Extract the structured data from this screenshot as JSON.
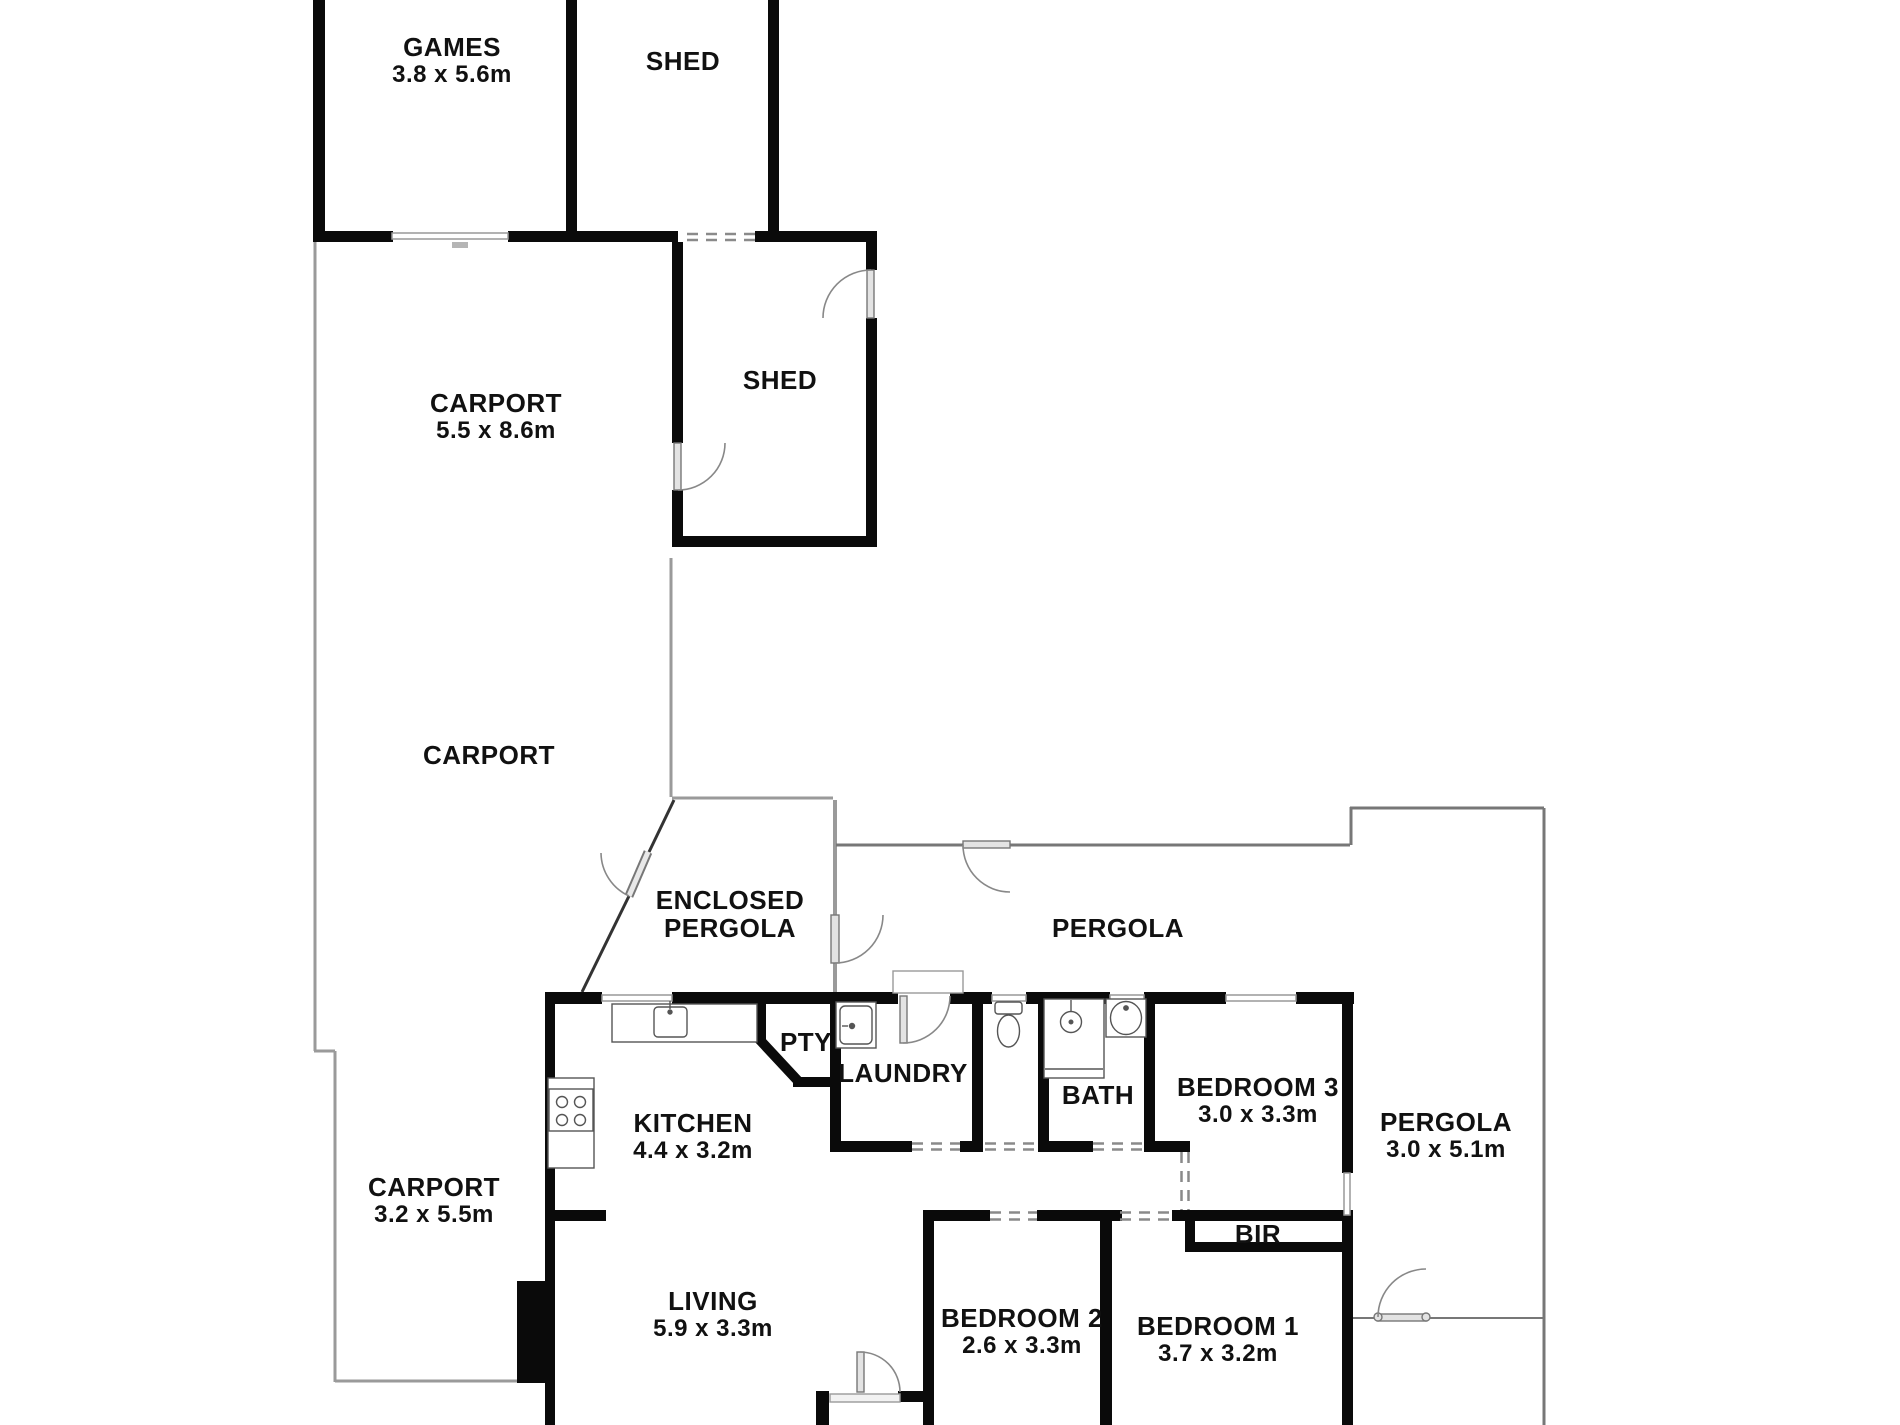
{
  "plan": {
    "type": "residential-floor-plan",
    "background_color": "#ffffff",
    "wall_color": "#0a0a0a",
    "outline_color": "#9a9a9a",
    "rooms": {
      "games": {
        "label": "GAMES",
        "dims": "3.8 x 5.6m"
      },
      "shed_top": {
        "label": "SHED"
      },
      "carport_main": {
        "label": "CARPORT",
        "dims": "5.5 x 8.6m"
      },
      "shed_rear": {
        "label": "SHED"
      },
      "carport_mid": {
        "label": "CARPORT"
      },
      "enclosed_pergola": {
        "label": "ENCLOSED PERGOLA"
      },
      "pergola_top": {
        "label": "PERGOLA"
      },
      "kitchen": {
        "label": "KITCHEN",
        "dims": "4.4 x 3.2m"
      },
      "pantry": {
        "label": "PTY"
      },
      "laundry": {
        "label": "LAUNDRY"
      },
      "bath": {
        "label": "BATH"
      },
      "bedroom3": {
        "label": "BEDROOM 3",
        "dims": "3.0 x 3.3m"
      },
      "pergola_right": {
        "label": "PERGOLA",
        "dims": "3.0 x 5.1m"
      },
      "carport_small": {
        "label": "CARPORT",
        "dims": "3.2 x 5.5m"
      },
      "living": {
        "label": "LIVING",
        "dims": "5.9 x 3.3m"
      },
      "bedroom2": {
        "label": "BEDROOM 2",
        "dims": "2.6 x 3.3m"
      },
      "bedroom1": {
        "label": "BEDROOM 1",
        "dims": "3.7 x 3.2m"
      },
      "bir": {
        "label": "BIR"
      }
    }
  }
}
